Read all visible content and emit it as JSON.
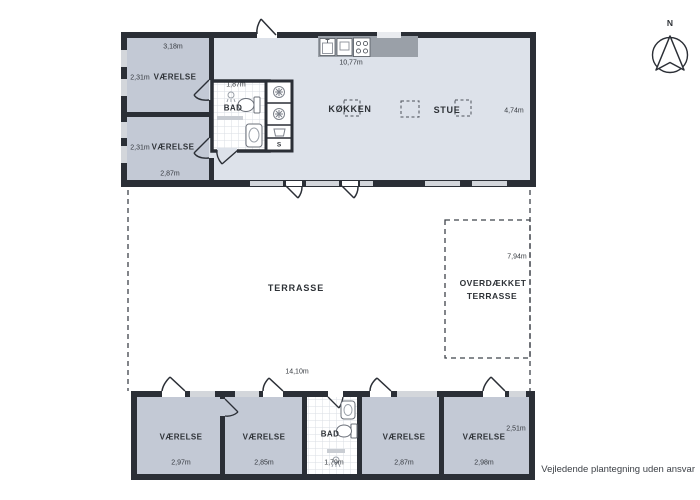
{
  "compass": {
    "north_label": "N"
  },
  "footer": {
    "disclaimer": "Vejledende plantegning uden ansvar"
  },
  "upper_building": {
    "bedroom_top": {
      "name": "VÆRELSE",
      "width": "3,18m",
      "depth": "2,31m"
    },
    "bedroom_bottom": {
      "name": "VÆRELSE",
      "width": "2,87m",
      "depth": "2,31m"
    },
    "bathroom": {
      "name": "BAD",
      "width": "1,87m"
    },
    "closet": {
      "label": "S"
    },
    "kitchen": {
      "name": "KØKKEN",
      "counter_width": "10,77m"
    },
    "living_room": {
      "name": "STUE",
      "depth": "4,74m"
    }
  },
  "terrace": {
    "name": "TERRASSE",
    "width": "14,10m"
  },
  "covered_terrace": {
    "name_line1": "OVERDÆKKET",
    "name_line2": "TERRASSE",
    "depth": "7,94m"
  },
  "lower_building": {
    "bedroom_1": {
      "name": "VÆRELSE",
      "width": "2,97m"
    },
    "bedroom_2": {
      "name": "VÆRELSE",
      "width": "2,85m"
    },
    "bathroom": {
      "name": "BAD",
      "width": "1,79m"
    },
    "bedroom_3": {
      "name": "VÆRELSE",
      "width": "2,87m"
    },
    "bedroom_4": {
      "name": "VÆRELSE",
      "width": "2,98m",
      "depth": "2,51m"
    }
  },
  "colors": {
    "wall": "#2b2f36",
    "bedroom_fill": "#c3c9d5",
    "living_fill": "#dde2ea",
    "window_fill": "#d3d6db",
    "counter": "#9aa0a8"
  }
}
